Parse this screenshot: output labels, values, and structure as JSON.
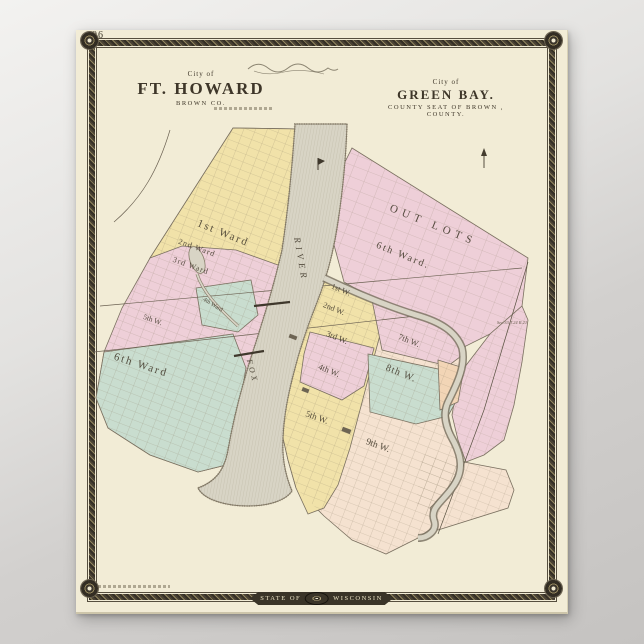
{
  "poster": {
    "page_number": "96",
    "titles": {
      "left": {
        "kicker": "City of",
        "title": "FT. HOWARD",
        "subtitle": "BROWN CO."
      },
      "right": {
        "kicker": "City of",
        "title": "GREEN BAY.",
        "subtitle": "COUNTY SEAT OF BROWN , COUNTY."
      }
    },
    "banner": {
      "left": "STATE OF",
      "right": "WISCONSIN"
    },
    "map": {
      "colors": {
        "ward_yellow": "#f1e2a9",
        "ward_pink": "#eecfd8",
        "ward_green": "#c9ddcf",
        "ward_peach": "#f2d5b6",
        "ward_cream": "#f5e2d0",
        "river": "#d8d4c5",
        "paper": "#f2ecd6",
        "ink": "#4a4335",
        "frame": "#3c362c"
      },
      "labels": {
        "fh1": "1st Ward",
        "fh2": "2nd Ward",
        "fh3": "3rd Ward",
        "fh4": "4th Ward",
        "fh5": "5th W.",
        "fh6": "6th Ward",
        "fox": "FOX",
        "river": "RIVER",
        "outlots": "OUT LOTS",
        "gb6": "6th Ward.",
        "gb1": "1st W.",
        "gb2": "2nd W.",
        "gb3": "3rd W.",
        "gb4": "4th W.",
        "gb7": "7th W.",
        "gb8": "8th W.",
        "gb5": "5th W.",
        "gb9": "9th W.",
        "secnote": "Sec.33 T.24 R.21"
      }
    }
  }
}
